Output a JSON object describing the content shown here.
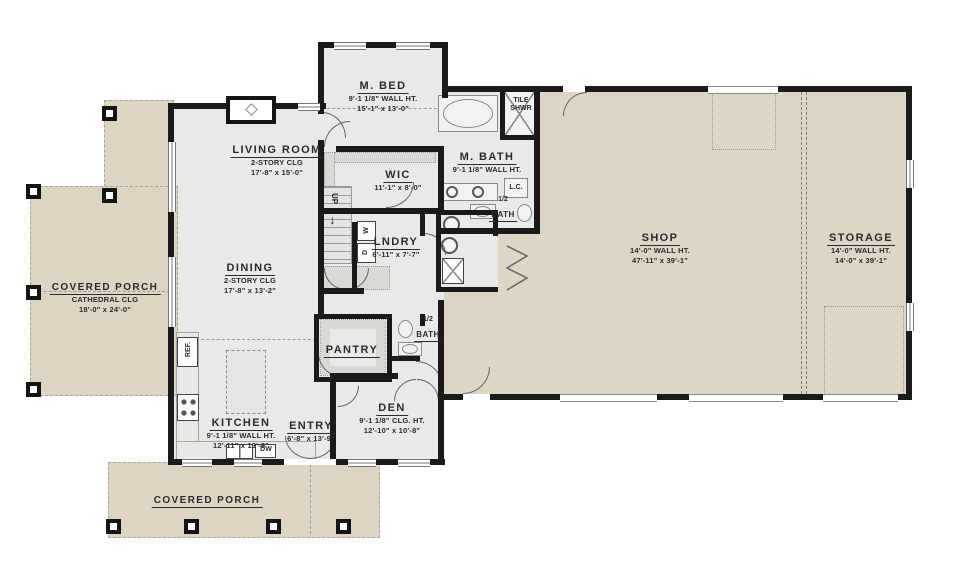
{
  "plan": {
    "rooms": {
      "living": {
        "name": "LIVING ROOM",
        "l1": "2-STORY CLG",
        "l2": "17'-8\" x 15'-0\""
      },
      "dining": {
        "name": "DINING",
        "l1": "2-STORY CLG",
        "l2": "17'-8\" x 13'-2\""
      },
      "kitchen": {
        "name": "KITCHEN",
        "l1": "9'-1 1/8\" WALL HT.",
        "l2": "12'-11\" x 13'-9\""
      },
      "entry": {
        "name": "ENTRY",
        "l1": "6'-8\" x 13'-9\""
      },
      "den": {
        "name": "DEN",
        "l1": "9'-1 1/8\" CLG. HT.",
        "l2": "12'-10\" x 10'-8\""
      },
      "mbed": {
        "name": "M. BED",
        "l1": "9'-1 1/8\" WALL HT.",
        "l2": "15'-1\" x 13'-0\""
      },
      "mbath": {
        "name": "M. BATH",
        "l1": "9'-1 1/8\" WALL HT."
      },
      "wic": {
        "name": "WIC",
        "l1": "11'-1\" x 8'-0\""
      },
      "lndry": {
        "name": "LNDRY",
        "l1": "6'-11\" x 7'-7\""
      },
      "pantry": {
        "name": "PANTRY"
      },
      "half_bath_main": {
        "name_top": "1/2",
        "name": "BATH"
      },
      "half_bath_den": {
        "name_top": "1/2",
        "name": "BATH"
      },
      "shop": {
        "name": "SHOP",
        "l1": "14'-0\" WALL HT.",
        "l2": "47'-11\" x 39'-1\""
      },
      "storage": {
        "name": "STORAGE",
        "l1": "14'-0\" WALL HT.",
        "l2": "14'-0\" x 39'-1\""
      },
      "porch_left": {
        "name": "COVERED PORCH",
        "l1": "CATHEDRAL CLG",
        "l2": "18'-0\" x 24'-0\""
      },
      "porch_bottom": {
        "name": "COVERED PORCH"
      },
      "tile_shwr": {
        "line1": "TILE",
        "line2": "SHWR"
      }
    },
    "annotations": {
      "up": "UP",
      "ref": "REF.",
      "dw": "DW",
      "washer": "W",
      "dryer": "D",
      "lc": "L.C."
    },
    "colors": {
      "wall": "#1a1a1a",
      "house_floor": "#e9e9e7",
      "porch_floor": "#ddd5c2",
      "shop_floor": "#ded6c4",
      "line": "#8a8a8a"
    }
  }
}
